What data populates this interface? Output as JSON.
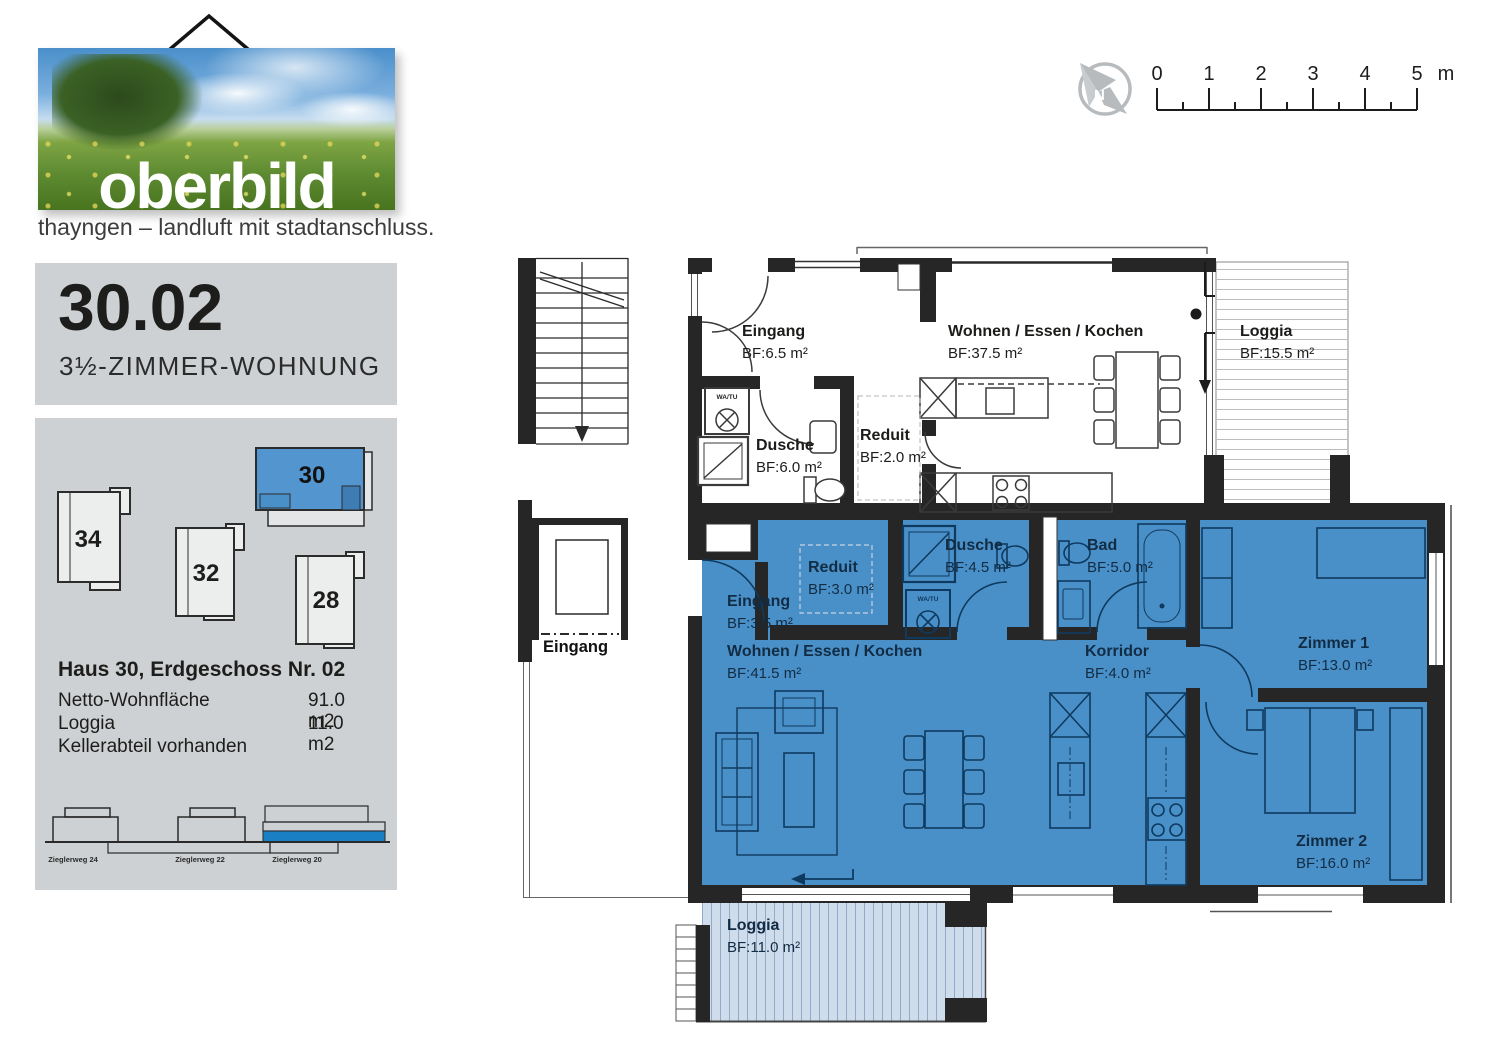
{
  "brand": {
    "logo_text": "oberbild",
    "tagline": "thayngen – landluft mit stadtanschluss."
  },
  "title_panel": {
    "unit_number": "30.02",
    "unit_type": "3½-ZIMMER-WOHNUNG"
  },
  "info_panel": {
    "site_buildings": [
      {
        "label": "34",
        "highlighted": false
      },
      {
        "label": "32",
        "highlighted": false
      },
      {
        "label": "28",
        "highlighted": false
      },
      {
        "label": "30",
        "highlighted": true
      }
    ],
    "details_title": "Haus 30, Erdgeschoss Nr. 02",
    "details": [
      {
        "label": "Netto-Wohnfläche",
        "value": "91.0 m2"
      },
      {
        "label": "Loggia",
        "value": "11.0 m2"
      },
      {
        "label": "Kellerabteil vorhanden",
        "value": ""
      }
    ],
    "elevation_labels": [
      "Zieglerweg 24",
      "Zieglerweg 22",
      "Zieglerweg 20"
    ]
  },
  "scale_bar": {
    "ticks": [
      "0",
      "1",
      "2",
      "3",
      "4",
      "5"
    ],
    "unit": "m"
  },
  "compass": {
    "letter": "N"
  },
  "floor_plan": {
    "building_entrance": "Eingang",
    "watu_label": "WA/TU",
    "upper_unit_rooms": [
      {
        "name": "Eingang",
        "area": "BF:6.5 m²"
      },
      {
        "name": "Wohnen / Essen / Kochen",
        "area": "BF:37.5 m²"
      },
      {
        "name": "Loggia",
        "area": "BF:15.5 m²"
      },
      {
        "name": "Dusche",
        "area": "BF:6.0 m²"
      },
      {
        "name": "Reduit",
        "area": "BF:2.0 m²"
      }
    ],
    "apartment_rooms": [
      {
        "name": "Eingang",
        "area": "BF:3.5 m²"
      },
      {
        "name": "Reduit",
        "area": "BF:3.0 m²"
      },
      {
        "name": "Dusche",
        "area": "BF:4.5 m²"
      },
      {
        "name": "Bad",
        "area": "BF:5.0 m²"
      },
      {
        "name": "Wohnen / Essen / Kochen",
        "area": "BF:41.5 m²"
      },
      {
        "name": "Korridor",
        "area": "BF:4.0 m²"
      },
      {
        "name": "Zimmer 1",
        "area": "BF:13.0 m²"
      },
      {
        "name": "Zimmer 2",
        "area": "BF:16.0 m²"
      },
      {
        "name": "Loggia",
        "area": "BF:11.0 m²"
      }
    ]
  },
  "colors": {
    "apartment_blue": "#4a90c8",
    "loggia_blue": "#cfdcec",
    "panel_gray": "#ced1d3",
    "site_highlight_blue": "#5395cf",
    "elevation_blue": "#1b7fc4",
    "wall_black": "#262626"
  }
}
